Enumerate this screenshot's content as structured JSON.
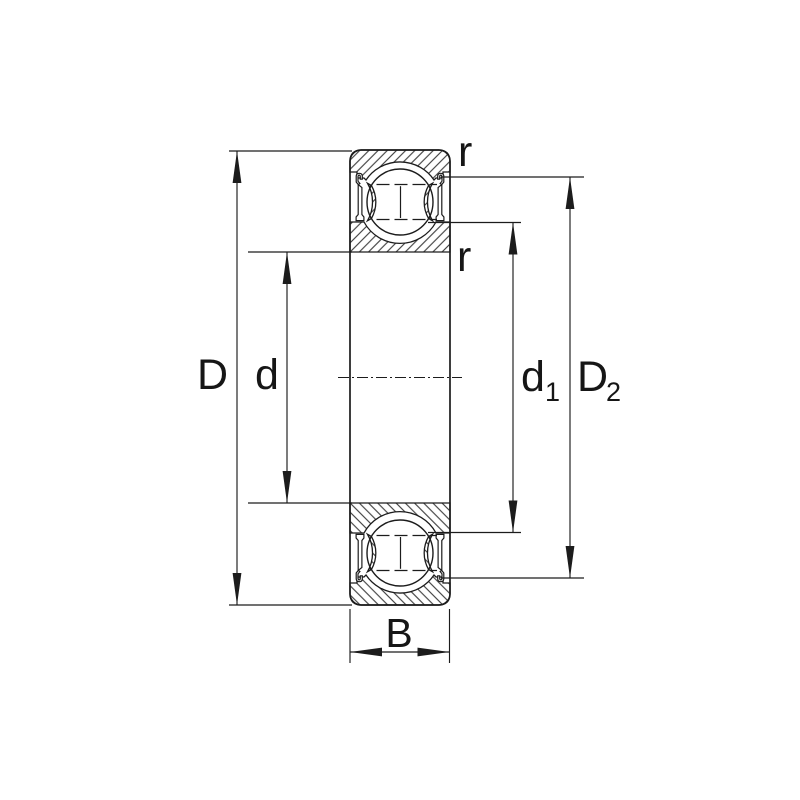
{
  "diagram": {
    "colors": {
      "line": "#1c1c1c",
      "background": "#ffffff"
    },
    "labels": {
      "outer_diameter": "D",
      "bore_diameter": "d",
      "d1": {
        "main": "d",
        "sub": "1"
      },
      "D2": {
        "main": "D",
        "sub": "2"
      },
      "width": "B",
      "fillet_upper": "r",
      "fillet_lower": "r"
    }
  }
}
